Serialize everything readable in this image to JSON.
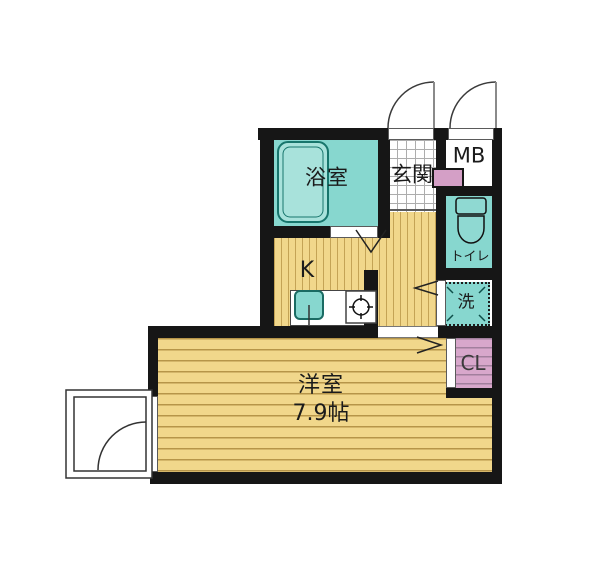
{
  "rooms": {
    "bathroom": {
      "label": "浴室"
    },
    "entrance": {
      "label": "玄関"
    },
    "meter_box": {
      "label": "MB"
    },
    "toilet": {
      "label": "トイレ"
    },
    "kitchen": {
      "label": "K"
    },
    "laundry": {
      "label": "洗"
    },
    "closet": {
      "label": "CL"
    },
    "western_room": {
      "label": "洋室",
      "size": "7.9帖"
    }
  },
  "icons": {
    "bathtub": "double-outline-rounded-rect",
    "kitchen_sink": "rounded-square-with-drain-line",
    "stove_burner": "circle-with-cross-ticks",
    "toilet_fixture": "tank-and-bowl",
    "washer_pan": "dashed-square-with-corner-ticks",
    "entrance_door": "quarter-circle-swing",
    "mb_door": "quarter-circle-swing",
    "balcony_door": "framed-quarter-circle-swing",
    "folding_door": "chevron"
  },
  "colors": {
    "wall": "#161616",
    "wet_area_teal": "#87d7cf",
    "flooring_yellow": "#f1d78b",
    "flooring_stripe": "#b69549",
    "closet_pink": "#d8a7cb",
    "shaft_pink": "#d49fc6",
    "tile_grid": "#adadad",
    "background": "#ffffff"
  }
}
